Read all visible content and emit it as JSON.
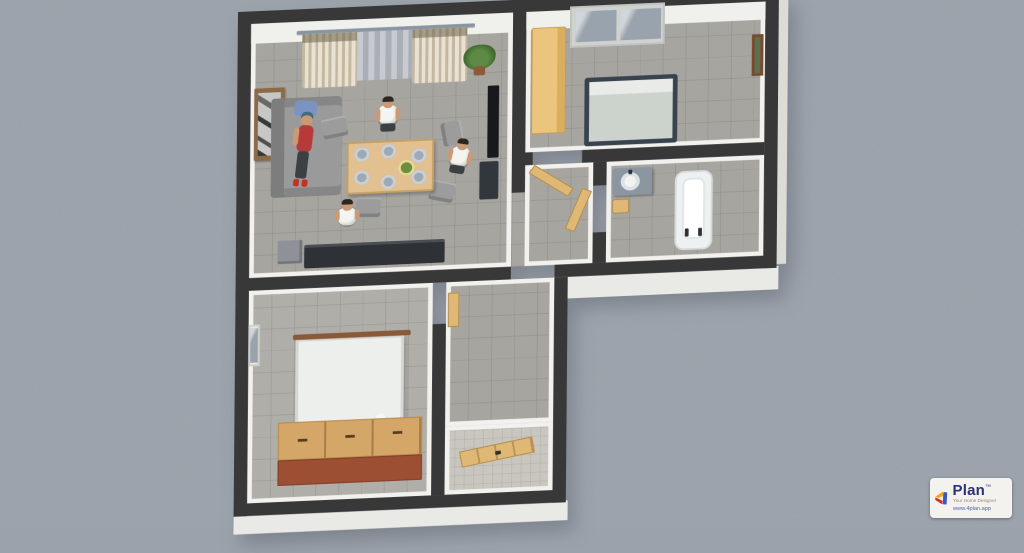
{
  "scene": {
    "type": "3d-floor-plan-render",
    "view": "top-down-perspective",
    "background_color": "#9aa2ab",
    "wall_color": "#383838",
    "wall_face_color": "#f2f1ed",
    "floor_tile_color": "#a7a5a0",
    "people_count": 4,
    "rooms": [
      {
        "name": "living-dining-room",
        "furniture": [
          "curtained window",
          "curtain rod",
          "potted plant",
          "framed wall art",
          "gray sofa",
          "blue cushion",
          "wall tv",
          "tv cabinet",
          "dining table with plates and salad bowl",
          "four chairs",
          "dark sideboard",
          "storage box"
        ],
        "occupants": [
          "woman lying on sofa",
          "man standing north of table",
          "man seated at table",
          "man standing east of table"
        ]
      },
      {
        "name": "bedroom",
        "furniture": [
          "light wood wardrobe",
          "window with blinds",
          "double bed with gray duvet",
          "framed picture"
        ]
      },
      {
        "name": "hallway",
        "furniture": [
          "open wooden door to bedroom",
          "open wooden door to bathroom"
        ]
      },
      {
        "name": "bathroom",
        "furniture": [
          "vanity with round sink",
          "wooden stool",
          "bathtub with two taps"
        ]
      },
      {
        "name": "bedroom-2",
        "furniture": [
          "side window",
          "white panel screen",
          "wooden chest of drawers",
          "table lamp"
        ]
      },
      {
        "name": "entry-corridor",
        "furniture": [
          "wall shelf",
          "open wooden entry door",
          "white tile entry floor"
        ]
      }
    ]
  },
  "watermark": {
    "brand": "Plan",
    "trademark": "™",
    "tagline": "Your Home Designer",
    "url": "www.4plan.app",
    "colors": {
      "brand_text": "#2b3270",
      "tagline_text": "#93867a",
      "url_text": "#4a5fae",
      "badge_bg": "#f4f2ef",
      "icon_yellow": "#f0a81c",
      "icon_red": "#d93025",
      "icon_blue": "#3b57c4"
    }
  }
}
